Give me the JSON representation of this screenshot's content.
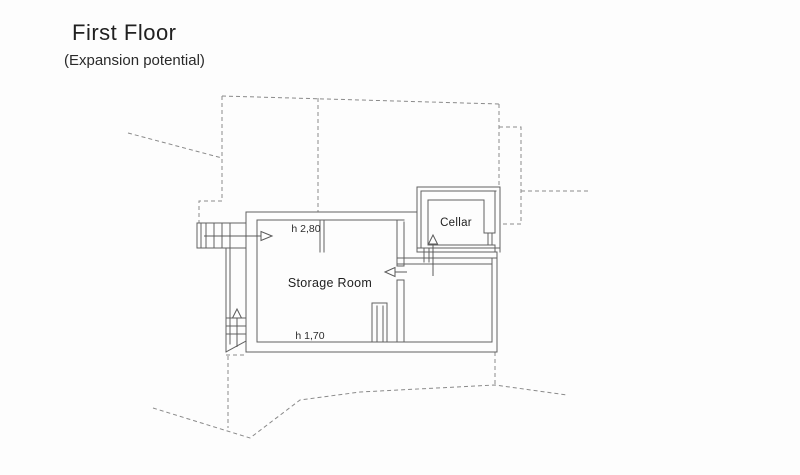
{
  "page": {
    "title": "First Floor",
    "subtitle": "(Expansion potential)"
  },
  "plan": {
    "rooms": [
      {
        "id": "storage-room",
        "label": "Storage Room"
      },
      {
        "id": "cellar",
        "label": "Cellar"
      }
    ],
    "annotations": [
      {
        "id": "ceiling-height-upper",
        "label": "h 2,80"
      },
      {
        "id": "ceiling-height-lower",
        "label": "h 1,70"
      }
    ],
    "symbols": [
      {
        "id": "entry-arrow",
        "meaning": "entry direction from upper stairs"
      },
      {
        "id": "stairs-down-arrow",
        "meaning": "lower stair flight direction"
      },
      {
        "id": "cellar-stairs-arrow",
        "meaning": "steps up to cellar"
      },
      {
        "id": "door-swing-arrow",
        "meaning": "passage into storage room"
      }
    ],
    "colors": {
      "wall": "#616161",
      "boundary_dash": "#8a8a8a",
      "text": "#1f1f1f",
      "paper": "#fdfdfd"
    }
  }
}
